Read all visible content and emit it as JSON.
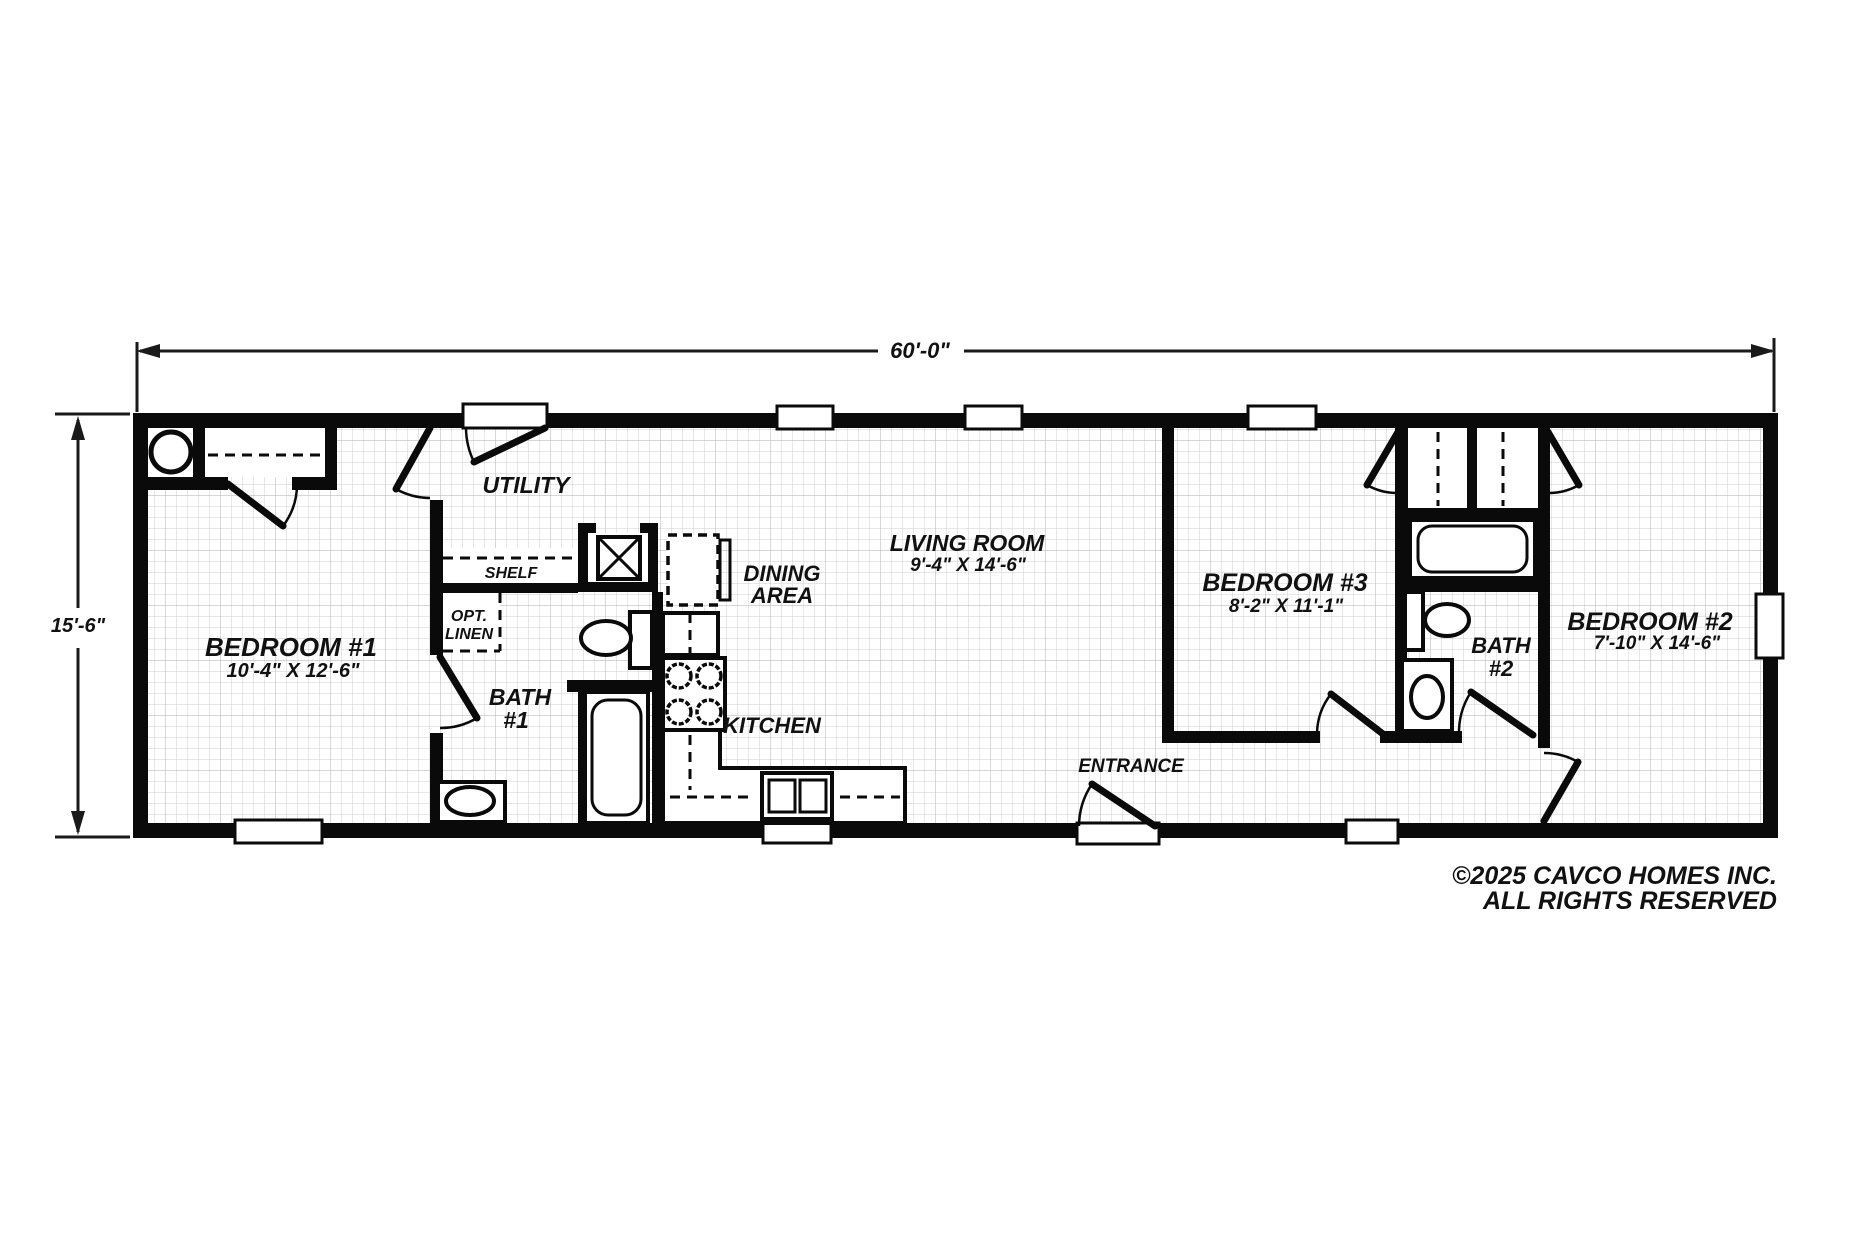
{
  "plan": {
    "width_dim": "60'-0\"",
    "height_dim": "15'-6\"",
    "rooms": {
      "bedroom1": {
        "name": "BEDROOM #1",
        "size": "10'-4\" X 12'-6\""
      },
      "bedroom2": {
        "name": "BEDROOM #2",
        "size": "7'-10\" X 14'-6\""
      },
      "bedroom3": {
        "name": "BEDROOM #3",
        "size": "8'-2\" X 11'-1\""
      },
      "living_room": {
        "name": "LIVING ROOM",
        "size": "9'-4\" X 14'-6\""
      },
      "dining_area": {
        "line1": "DINING",
        "line2": "AREA"
      },
      "kitchen": {
        "name": "KITCHEN"
      },
      "utility": {
        "name": "UTILITY"
      },
      "bath1": {
        "line1": "BATH",
        "line2": "#1"
      },
      "bath2": {
        "line1": "BATH",
        "line2": "#2"
      },
      "entrance": {
        "name": "ENTRANCE"
      },
      "shelf": {
        "name": "SHELF"
      },
      "opt_linen": {
        "line1": "OPT.",
        "line2": "LINEN"
      }
    },
    "copyright": {
      "line1": "©2025 CAVCO HOMES INC.",
      "line2": "ALL RIGHTS RESERVED"
    },
    "colors": {
      "wall": "#0a0a0a",
      "grid_minor": "#cfcfcf",
      "grid_major": "#bdbdbd",
      "background": "#ffffff",
      "text": "#111111"
    }
  }
}
